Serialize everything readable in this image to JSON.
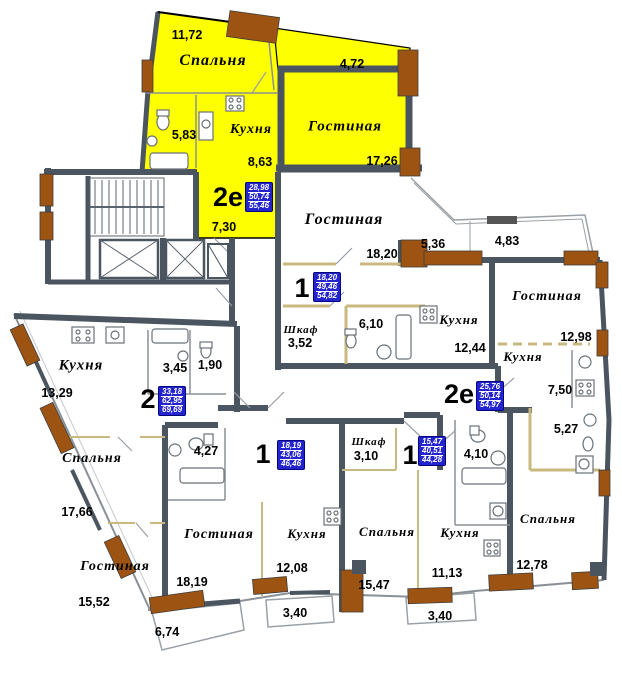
{
  "plan": {
    "title": "Поэтажный план — типовой этаж",
    "colors": {
      "wall": "#4a5560",
      "column": "#9d5413",
      "highlight_apartment": "#feff00",
      "partition": "#c8b97e",
      "summary_box_bg": "#2424cf",
      "summary_box_text": "#ffffff",
      "text": "#000000"
    },
    "units": [
      {
        "type": "2е",
        "summary": [
          "28,98",
          "50,74",
          "55,46"
        ],
        "type_pos": {
          "x": 228,
          "y": 197
        },
        "box_pos": {
          "x": 245,
          "y": 182
        }
      },
      {
        "type": "1",
        "summary": [
          "18,20",
          "49,46",
          "54,82"
        ],
        "type_pos": {
          "x": 302,
          "y": 288
        },
        "box_pos": {
          "x": 313,
          "y": 272
        }
      },
      {
        "type": "2",
        "summary": [
          "33,18",
          "62,95",
          "69,69"
        ],
        "type_pos": {
          "x": 148,
          "y": 399
        },
        "box_pos": {
          "x": 158,
          "y": 386
        }
      },
      {
        "type": "2е",
        "summary": [
          "25,76",
          "50,14",
          "54,97"
        ],
        "type_pos": {
          "x": 459,
          "y": 394
        },
        "box_pos": {
          "x": 476,
          "y": 381
        }
      },
      {
        "type": "1",
        "summary": [
          "18,19",
          "43,06",
          "46,46"
        ],
        "type_pos": {
          "x": 263,
          "y": 454
        },
        "box_pos": {
          "x": 277,
          "y": 440
        }
      },
      {
        "type": "1",
        "summary": [
          "15,47",
          "40,51",
          "44,28"
        ],
        "type_pos": {
          "x": 410,
          "y": 455
        },
        "box_pos": {
          "x": 418,
          "y": 436
        }
      }
    ],
    "rooms": [
      {
        "name": "Спальня",
        "x": 213,
        "y": 61,
        "size": 16
      },
      {
        "name": "Кухня",
        "x": 251,
        "y": 130,
        "size": 14
      },
      {
        "name": "Гостиная",
        "x": 345,
        "y": 127,
        "size": 15
      },
      {
        "name": "Гостиная",
        "x": 344,
        "y": 220,
        "size": 16
      },
      {
        "name": "Кухня",
        "x": 459,
        "y": 320,
        "size": 13
      },
      {
        "name": "Гостиная",
        "x": 547,
        "y": 297,
        "size": 14
      },
      {
        "name": "Кухня",
        "x": 523,
        "y": 357,
        "size": 13
      },
      {
        "name": "Шкаф",
        "x": 301,
        "y": 330,
        "size": 11
      },
      {
        "name": "Кухня",
        "x": 81,
        "y": 366,
        "size": 15
      },
      {
        "name": "Спальня",
        "x": 92,
        "y": 459,
        "size": 14
      },
      {
        "name": "Шкаф",
        "x": 369,
        "y": 442,
        "size": 11
      },
      {
        "name": "Гостиная",
        "x": 115,
        "y": 567,
        "size": 14
      },
      {
        "name": "Гостиная",
        "x": 219,
        "y": 535,
        "size": 14
      },
      {
        "name": "Кухня",
        "x": 307,
        "y": 534,
        "size": 13
      },
      {
        "name": "Спальня",
        "x": 387,
        "y": 532,
        "size": 13
      },
      {
        "name": "Кухня",
        "x": 460,
        "y": 533,
        "size": 13
      },
      {
        "name": "Спальня",
        "x": 548,
        "y": 519,
        "size": 13
      }
    ],
    "areas": [
      {
        "value": "11,72",
        "x": 187,
        "y": 35
      },
      {
        "value": "4,72",
        "x": 352,
        "y": 64
      },
      {
        "value": "5,83",
        "x": 184,
        "y": 135
      },
      {
        "value": "8,63",
        "x": 260,
        "y": 162
      },
      {
        "value": "17,26",
        "x": 382,
        "y": 161
      },
      {
        "value": "7,30",
        "x": 224,
        "y": 227
      },
      {
        "value": "18,20",
        "x": 382,
        "y": 254
      },
      {
        "value": "5,36",
        "x": 433,
        "y": 244
      },
      {
        "value": "4,83",
        "x": 507,
        "y": 241
      },
      {
        "value": "12,98",
        "x": 576,
        "y": 337
      },
      {
        "value": "12,44",
        "x": 470,
        "y": 348
      },
      {
        "value": "3,52",
        "x": 300,
        "y": 343
      },
      {
        "value": "6,10",
        "x": 371,
        "y": 324
      },
      {
        "value": "13,29",
        "x": 57,
        "y": 393
      },
      {
        "value": "3,45",
        "x": 175,
        "y": 368
      },
      {
        "value": "1,90",
        "x": 210,
        "y": 365
      },
      {
        "value": "7,50",
        "x": 560,
        "y": 390
      },
      {
        "value": "5,27",
        "x": 566,
        "y": 429
      },
      {
        "value": "4,10",
        "x": 476,
        "y": 454
      },
      {
        "value": "3,10",
        "x": 366,
        "y": 456
      },
      {
        "value": "4,27",
        "x": 206,
        "y": 451
      },
      {
        "value": "17,66",
        "x": 77,
        "y": 512
      },
      {
        "value": "15,52",
        "x": 94,
        "y": 602
      },
      {
        "value": "18,19",
        "x": 192,
        "y": 582
      },
      {
        "value": "12,08",
        "x": 292,
        "y": 568
      },
      {
        "value": "3,40",
        "x": 295,
        "y": 613
      },
      {
        "value": "15,47",
        "x": 374,
        "y": 585
      },
      {
        "value": "6,74",
        "x": 167,
        "y": 632
      },
      {
        "value": "11,13",
        "x": 447,
        "y": 573
      },
      {
        "value": "12,78",
        "x": 532,
        "y": 565
      },
      {
        "value": "3,40",
        "x": 440,
        "y": 616
      }
    ]
  }
}
